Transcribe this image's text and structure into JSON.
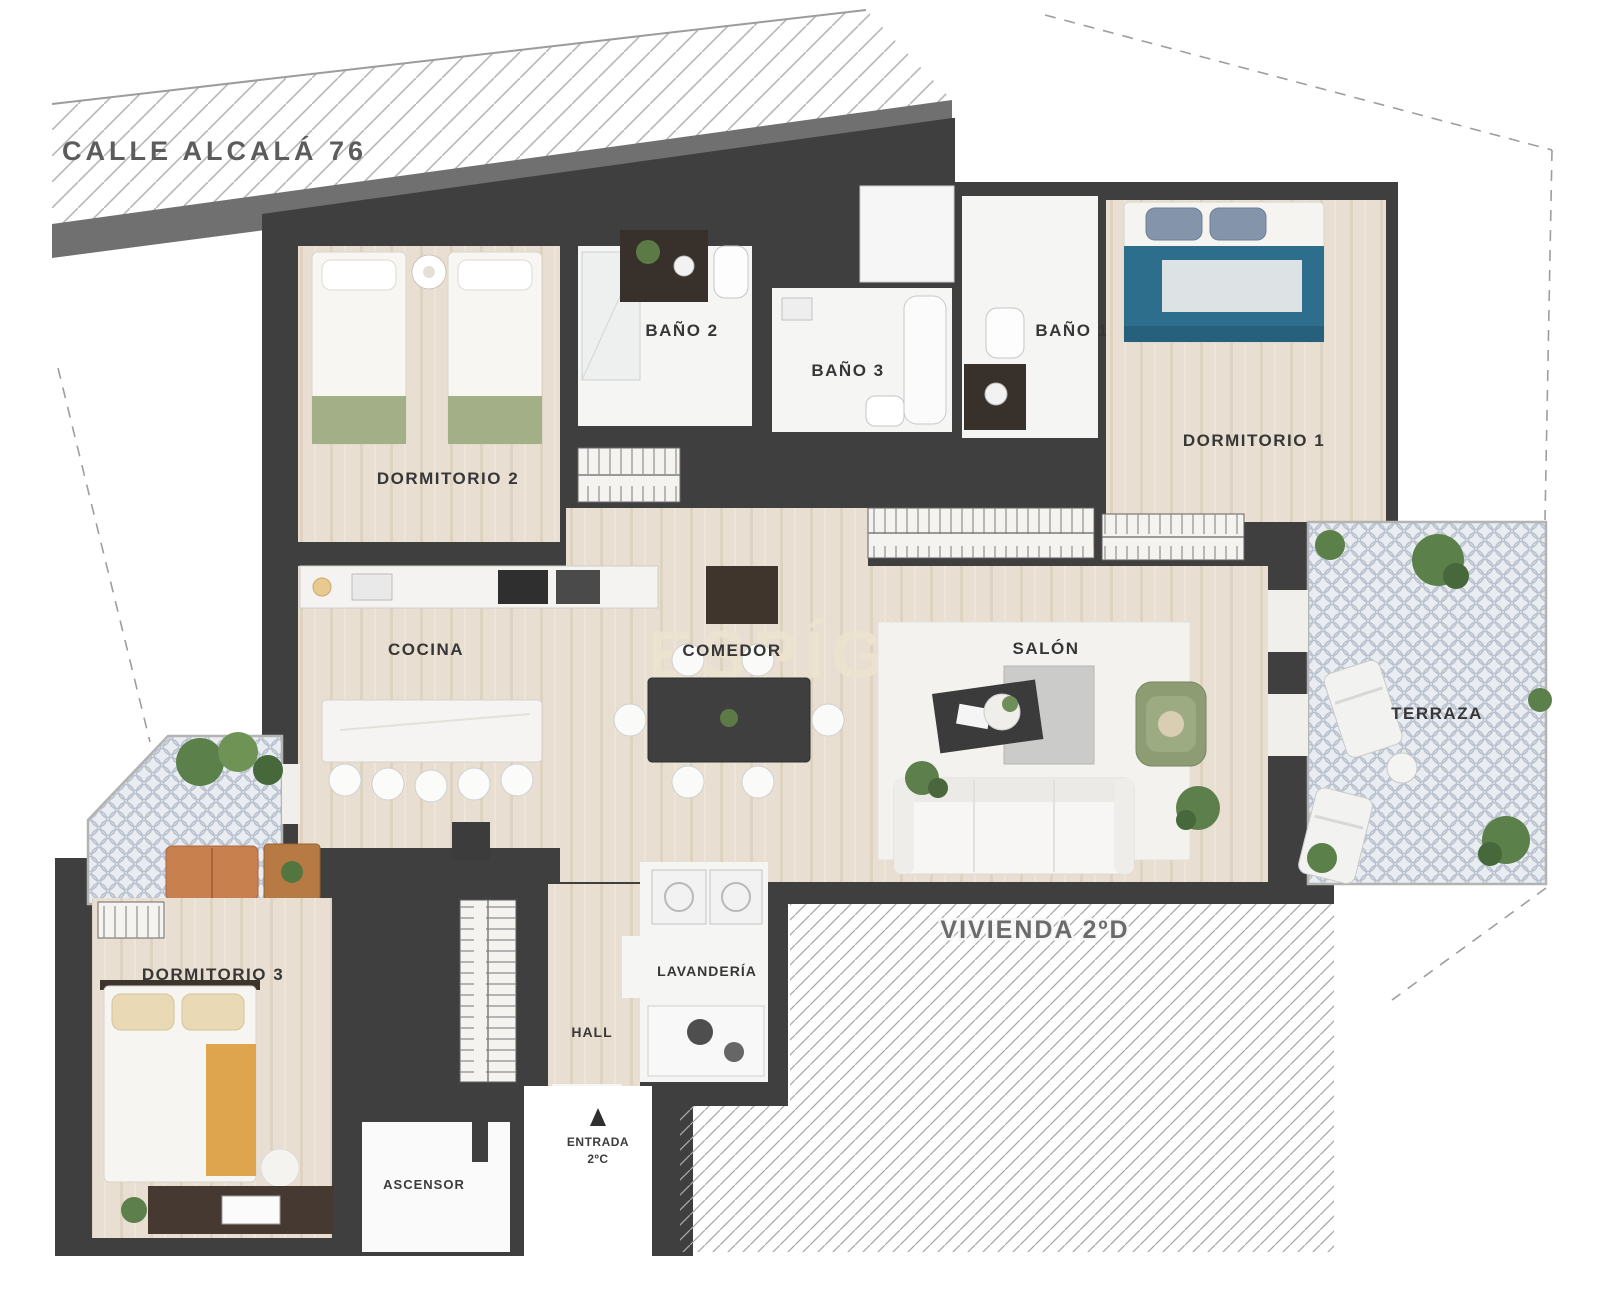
{
  "plan": {
    "street_label": "CALLE ALCALÁ 76",
    "watermark": "ESPÍGUL",
    "neighbor_label": "VIVIENDA 2ºD",
    "entrance": {
      "label_line1": "ENTRADA",
      "label_line2": "2ºC"
    },
    "rooms": {
      "dormitorio_1": {
        "label": "DORMITORIO 1"
      },
      "dormitorio_2": {
        "label": "DORMITORIO 2"
      },
      "dormitorio_3": {
        "label": "DORMITORIO 3"
      },
      "bano_1": {
        "label": "BAÑO 1"
      },
      "bano_2": {
        "label": "BAÑO 2"
      },
      "bano_3": {
        "label": "BAÑO 3"
      },
      "cocina": {
        "label": "COCINA"
      },
      "comedor": {
        "label": "COMEDOR"
      },
      "salon": {
        "label": "SALÓN"
      },
      "terraza": {
        "label": "TERRAZA"
      },
      "lavanderia": {
        "label": "LAVANDERÍA"
      },
      "hall": {
        "label": "HALL"
      },
      "ascensor": {
        "label": "ASCENSOR"
      }
    },
    "colors": {
      "wall": "#3f3f3f",
      "wood_floor": "#e8dfd2",
      "white_floor": "#f5f5f4",
      "road": "#707070",
      "bed_teal": "#2d6e8d",
      "armchair_green": "#8d9c72",
      "terrace_sofa_orange": "#c8804f",
      "throw_mustard": "#dfa54e",
      "plant_green": "#5d7f4c",
      "mosaic_tile": "#b9c1ce"
    }
  }
}
